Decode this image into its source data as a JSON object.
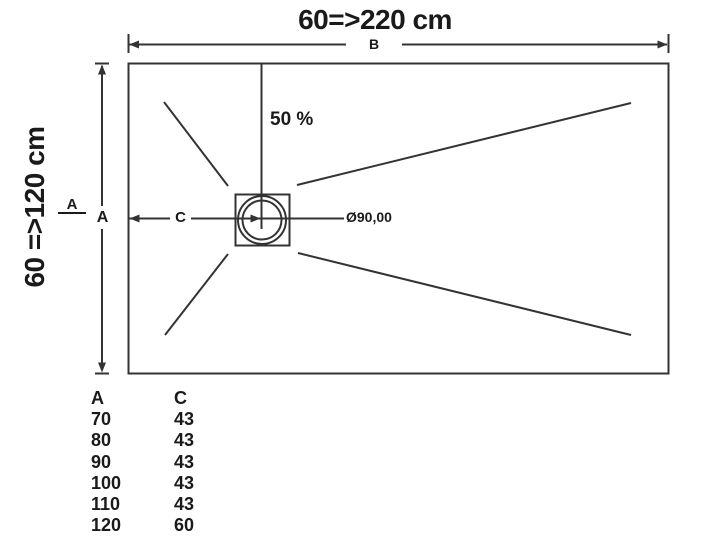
{
  "colors": {
    "line": "#333333",
    "text": "#1a1a1a",
    "background": "#ffffff"
  },
  "titles": {
    "width_range": "60=>220 cm",
    "height_range": "60 =>120 cm"
  },
  "dimensions": {
    "width_letter": "B",
    "height_letter": "A",
    "section_letter": "A",
    "slope_percent": "50 %",
    "drain_offset_letter": "C",
    "drain_diameter": "Ø90,00"
  },
  "table": {
    "col_a_header": "A",
    "col_c_header": "C",
    "rows": [
      {
        "a": "70",
        "c": "43"
      },
      {
        "a": "80",
        "c": "43"
      },
      {
        "a": "90",
        "c": "43"
      },
      {
        "a": "100",
        "c": "43"
      },
      {
        "a": "110",
        "c": "43"
      },
      {
        "a": "120",
        "c": "60"
      }
    ]
  }
}
